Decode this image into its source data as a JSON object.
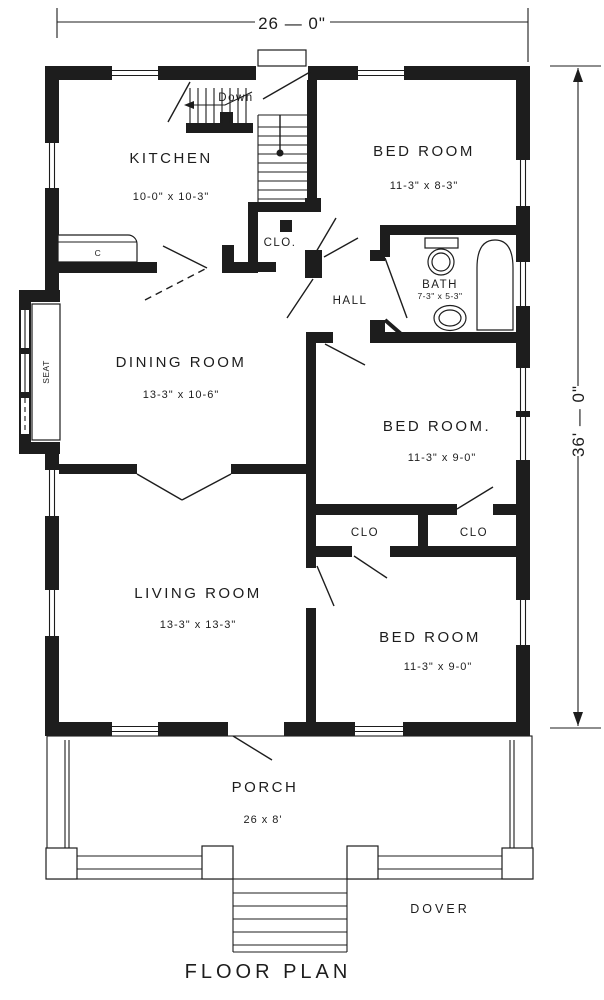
{
  "title": "FLOOR PLAN",
  "plan_name": "DOVER",
  "dimensions": {
    "width": "26 — 0\"",
    "depth": "36' — 0\""
  },
  "rooms": {
    "kitchen": {
      "name": "KITCHEN",
      "size": "10-0\" x 10-3\""
    },
    "bedroom_top": {
      "name": "BED ROOM",
      "size": "11-3\" x 8-3\""
    },
    "bath": {
      "name": "BATH",
      "size": "7-3\" x 5-3\""
    },
    "hall": {
      "name": "HALL"
    },
    "dining_room": {
      "name": "DINING ROOM",
      "size": "13-3\" x 10-6\""
    },
    "bedroom_middle": {
      "name": "BED ROOM.",
      "size": "11-3\" x 9-0\""
    },
    "living_room": {
      "name": "LIVING ROOM",
      "size": "13-3\" x 13-3\""
    },
    "bedroom_bottom": {
      "name": "BED ROOM",
      "size": "11-3\" x 9-0\""
    },
    "porch": {
      "name": "PORCH",
      "size": "26 x 8'"
    }
  },
  "labels": {
    "stairs_down": "Down",
    "closet_hall": "CLO.",
    "closet_left": "CLO",
    "closet_right": "CLO",
    "window_seat": "SEAT",
    "kitchen_cabinet": "C"
  },
  "colors": {
    "ink": "#1d1d1d",
    "paper": "#ffffff"
  }
}
